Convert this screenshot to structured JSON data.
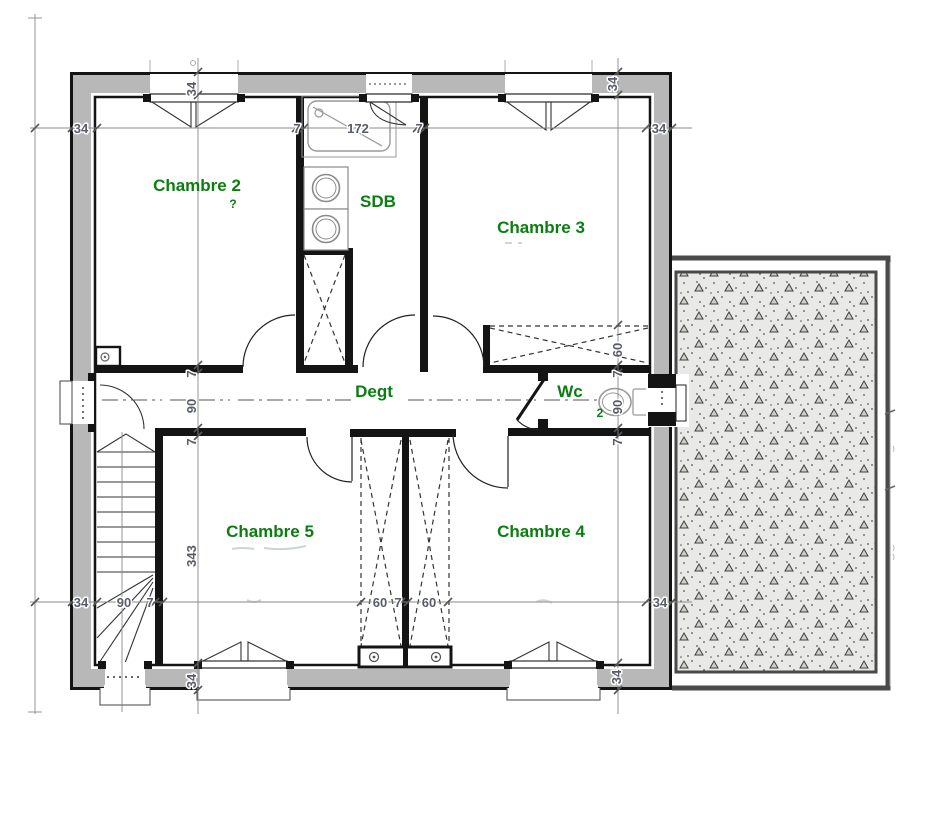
{
  "rooms": {
    "chambre2": "Chambre 2",
    "chambre2_remnant": "?",
    "sdb": "SDB",
    "chambre3": "Chambre 3",
    "degt": "Degt",
    "wc": "Wc",
    "wc_remnant": "2",
    "chambre5": "Chambre 5",
    "chambre4": "Chambre 4"
  },
  "dims": {
    "top_wall_left": "34",
    "top_win_c2": "34",
    "top_7a": "7",
    "top_172": "172",
    "top_7b": "7",
    "top_wall_right": "34",
    "top_win_c3": "34",
    "left_7a": "7",
    "left_90": "90",
    "left_7b": "7",
    "left_343": "343",
    "left_win_c5": "34",
    "right_60": "60",
    "right_7a": "7",
    "right_90": "90",
    "right_7b": "7",
    "right_win_c4": "34",
    "bottom_wall_left": "34",
    "bottom_90": "90",
    "bottom_7a": "7",
    "bottom_60a": "60",
    "bottom_7b": "7",
    "bottom_60b": "60",
    "bottom_wall_right": "34"
  },
  "colors": {
    "room_label": "#0b7e11",
    "dimension_text": "#575c68",
    "wall_fill": "#b8b8b8",
    "wall_line": "#141414",
    "terrace_fill": "#e9e9e7",
    "terrace_border": "#4a4a4a"
  }
}
